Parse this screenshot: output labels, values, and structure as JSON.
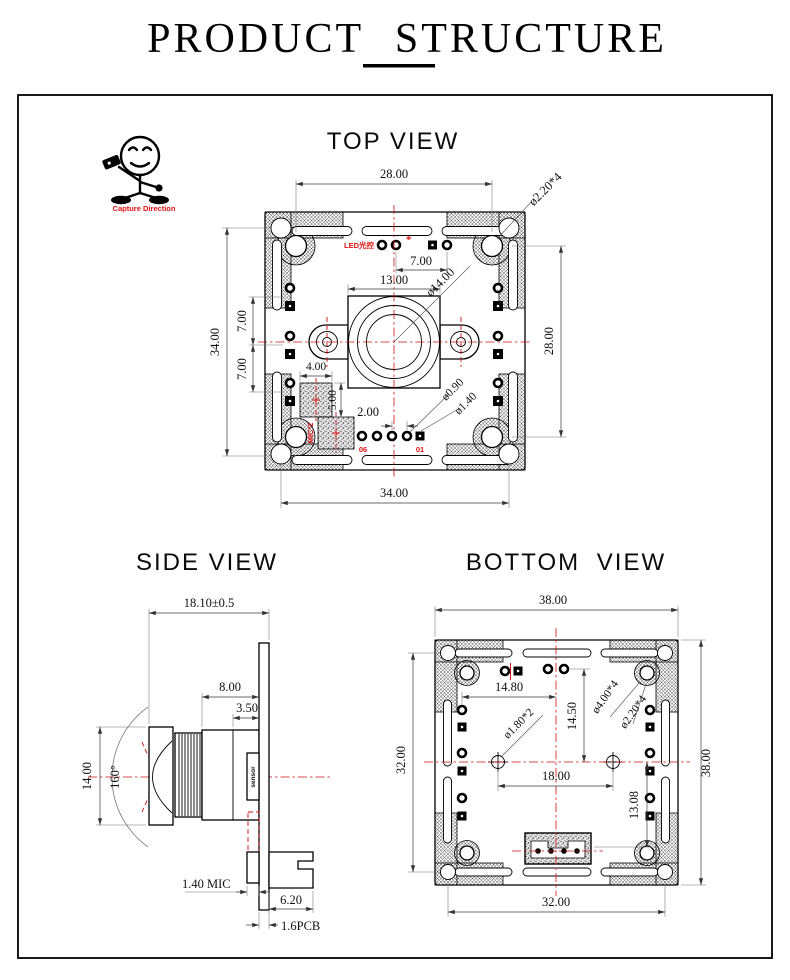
{
  "page": {
    "title": "PRODUCT STRUCTURE"
  },
  "capture": {
    "label": "Capture Direction"
  },
  "top_view": {
    "title": "TOP VIEW",
    "hole_pitch_top": "28.00",
    "corner_hole_dia": "ø2.20*4",
    "board_height": "34.00",
    "led_pitch_upper": "7.00",
    "led_pitch_lower": "7.00",
    "led_offset_top": "7.00",
    "holder_width": "13.00",
    "lens_dia": "ø14.00",
    "hole_pitch_right": "28.00",
    "mic_width": "4.00",
    "mic_height": "5.00",
    "pad_pitch": "2.00",
    "pad_hole_dia": "ø0.90",
    "pad_ring_dia": "ø1.40",
    "board_width_bottom": "34.00",
    "led_label": "LED光控",
    "led_mark": "*",
    "mic_label": "MIC*2",
    "pin_label_06": "06",
    "pin_label_01": "01"
  },
  "side_view": {
    "title": "SIDE VIEW",
    "total_depth": "18.10±0.5",
    "holder_depth": "8.00",
    "flange_depth": "3.50",
    "lens_dia": "14.00",
    "fov": "160°",
    "sensor_label": "sensor",
    "mic_thickness": "1.40 MIC",
    "connector_depth": "6.20",
    "pcb_thickness": "1.6PCB"
  },
  "bottom_view": {
    "title": "BOTTOM VIEW",
    "board_width_top": "38.00",
    "span_left": "32.00",
    "board_height_right": "38.00",
    "span_bottom": "32.00",
    "pad_offset_x": "14.80",
    "pad_offset_y": "14.50",
    "positioning_hole_dia": "ø1.80*2",
    "mount_pad_dia": "ø4.00*4",
    "mount_hole_dia": "ø2.20*4",
    "positioning_pitch": "18.00",
    "connector_offset": "13.08"
  }
}
